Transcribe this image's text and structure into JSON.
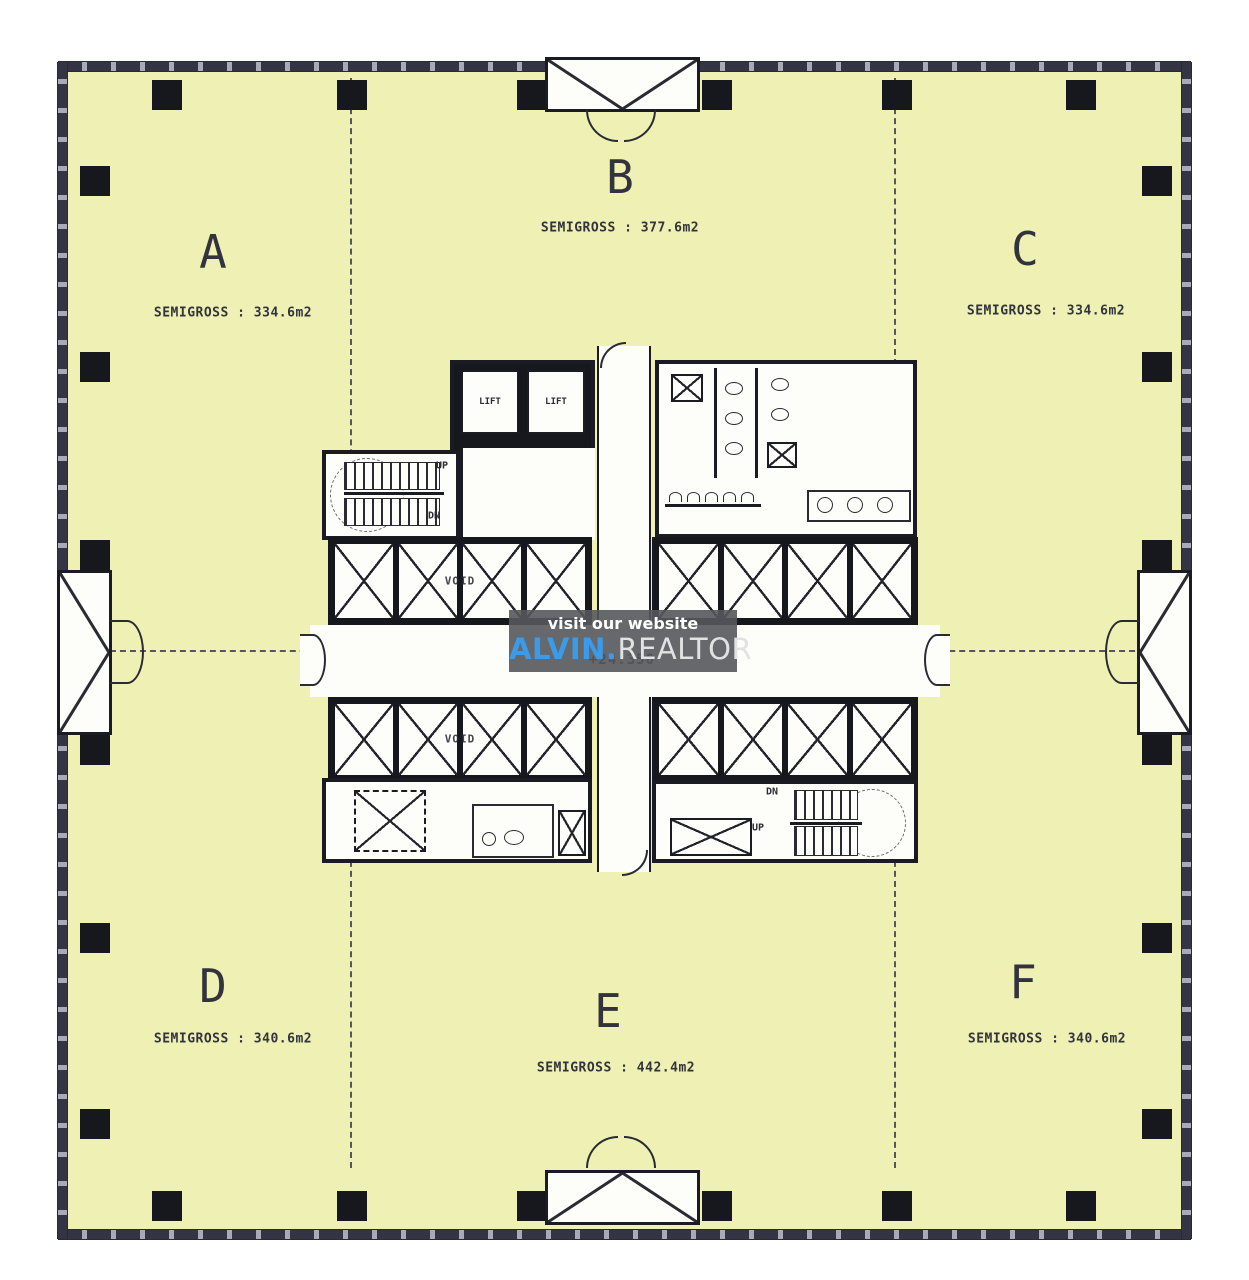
{
  "watermark": {
    "line1": "visit our website",
    "brand_primary": "ALVIN.",
    "brand_secondary": "REALTOR",
    "accent_color": "#3a9bea",
    "panel_color": "rgba(85,88,92,0.9)"
  },
  "floorplan": {
    "floor_color": "#eef0b4",
    "wall_color": "#343444",
    "level_label": "+24.350",
    "zones": [
      {
        "id": "A",
        "label": "A",
        "area_text": "SEMIGROSS : 334.6m2"
      },
      {
        "id": "B",
        "label": "B",
        "area_text": "SEMIGROSS : 377.6m2"
      },
      {
        "id": "C",
        "label": "C",
        "area_text": "SEMIGROSS : 334.6m2"
      },
      {
        "id": "D",
        "label": "D",
        "area_text": "SEMIGROSS : 340.6m2"
      },
      {
        "id": "E",
        "label": "E",
        "area_text": "SEMIGROSS : 442.4m2"
      },
      {
        "id": "F",
        "label": "F",
        "area_text": "SEMIGROSS : 340.6m2"
      }
    ],
    "core": {
      "lift_labels": [
        "LIFT",
        "LIFT"
      ],
      "void_labels": [
        "VOID",
        "VOID"
      ],
      "stair_top": {
        "up": "UP",
        "down": "DN"
      },
      "stair_bottom": {
        "up": "UP",
        "down": "DN"
      }
    }
  }
}
